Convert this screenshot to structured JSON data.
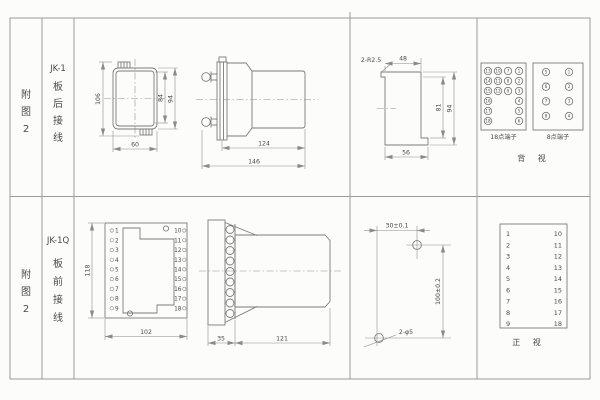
{
  "sheet": {
    "row1": {
      "appendix": [
        "附",
        "图",
        "2"
      ],
      "model": "JK-1",
      "mount": [
        "板",
        "后",
        "接",
        "线"
      ],
      "front": {
        "h_total": "106",
        "h_inner": "84",
        "h_outer": "94",
        "w_bottom": "60"
      },
      "side": {
        "d_body": "124",
        "d_total": "146"
      },
      "cutout": {
        "radius": "2-R2.5",
        "w_top": "48",
        "h_inner": "81",
        "h_outer": "94",
        "w_bottom": "56"
      },
      "t18": {
        "label": "18点端子",
        "c1": [
          "13",
          "14",
          "15",
          "16",
          "17",
          "18"
        ],
        "c2": [
          "10",
          "11",
          "12"
        ],
        "c3": [
          "7",
          "8",
          "9"
        ],
        "c4": [
          "1",
          "2",
          "3",
          "4",
          "5",
          "6"
        ]
      },
      "t8": {
        "label": "8点端子",
        "c1": [
          "5",
          "6",
          "7",
          "8"
        ],
        "c2": [
          "1",
          "2",
          "3",
          "4"
        ]
      },
      "view": "背 视"
    },
    "row2": {
      "appendix": [
        "附",
        "图",
        "2"
      ],
      "model": "JK-1Q",
      "mount": [
        "板",
        "前",
        "接",
        "线"
      ],
      "front": {
        "h": "118",
        "w": "102",
        "left": [
          "1",
          "2",
          "3",
          "4",
          "5",
          "6",
          "7",
          "8",
          "9"
        ],
        "right": [
          "10",
          "11",
          "12",
          "13",
          "14",
          "15",
          "16",
          "17",
          "18"
        ]
      },
      "side": {
        "d_front": "35",
        "d_body": "121"
      },
      "drill": {
        "w": "30±0.1",
        "h": "100±0.2",
        "holes": "2-φ5"
      },
      "table": {
        "left": [
          "1",
          "2",
          "3",
          "4",
          "5",
          "6",
          "7",
          "8",
          "9"
        ],
        "right": [
          "10",
          "11",
          "12",
          "13",
          "14",
          "15",
          "16",
          "17",
          "18"
        ]
      },
      "view": "正 视"
    }
  }
}
